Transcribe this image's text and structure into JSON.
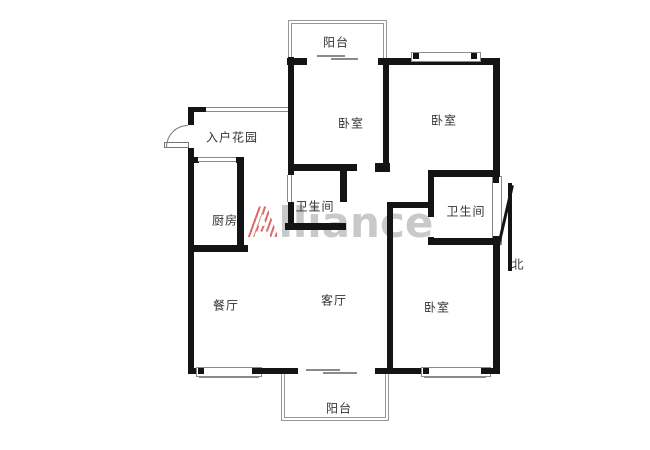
{
  "floorplan": {
    "rooms": {
      "balcony_top": "阳台",
      "bedroom_tl": "卧室",
      "bedroom_tr": "卧室",
      "entry_garden": "入户花园",
      "bath_left": "卫生间",
      "bath_right": "卫生间",
      "kitchen": "厨房",
      "dining": "餐厅",
      "living": "客厅",
      "bedroom_br": "卧室",
      "balcony_bottom": "阳台"
    },
    "compass_label": "北",
    "watermark": {
      "lead": "A",
      "rest": "lliance"
    },
    "colors": {
      "wall": "#141414",
      "thin_line": "#8a8a8a",
      "label_text": "#333333",
      "watermark_text": "#c9c9c9",
      "watermark_stripe": "#dd6a6a"
    }
  }
}
